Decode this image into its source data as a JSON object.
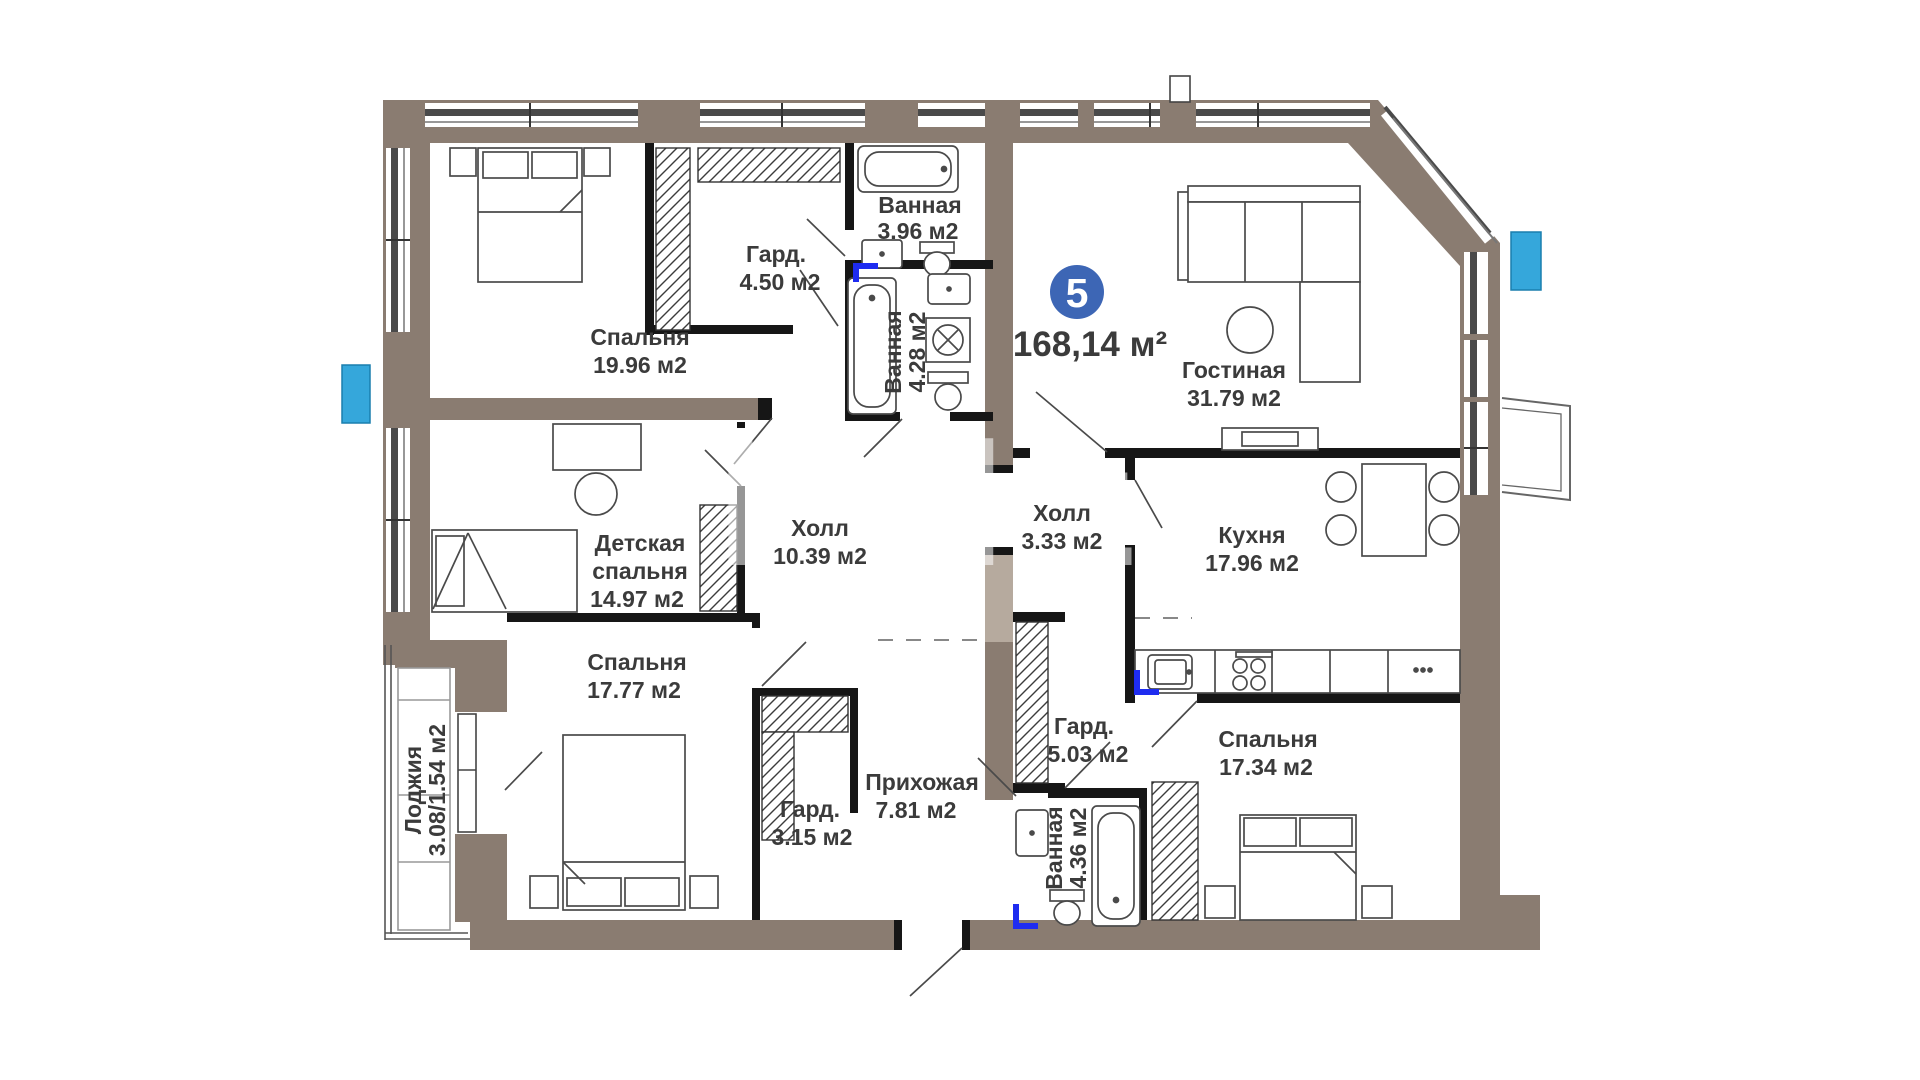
{
  "badge": {
    "number": "5",
    "total_area": "168,14 м²"
  },
  "watermark": {
    "text": "kn.kz"
  },
  "rooms": {
    "bedroom1": {
      "name": "Спальня",
      "area": "19.96 м2"
    },
    "wardrobe1": {
      "name": "Гард.",
      "area": "4.50 м2"
    },
    "bath1": {
      "name": "Ванная",
      "area": "3.96 м2"
    },
    "bath2": {
      "name": "Ванная",
      "area": "4.28 м2"
    },
    "living": {
      "name": "Гостиная",
      "area": "31.79 м2"
    },
    "kitchen": {
      "name": "Кухня",
      "area": "17.96 м2"
    },
    "hall_small": {
      "name": "Холл",
      "area": "3.33 м2"
    },
    "hall": {
      "name": "Холл",
      "area": "10.39 м2"
    },
    "kids": {
      "name_line1": "Детская",
      "name_line2": "спальня",
      "area": "14.97 м2"
    },
    "bedroom2": {
      "name": "Спальня",
      "area": "17.77 м2"
    },
    "loggia": {
      "name": "Лоджия",
      "area": "3.08/1.54 м2"
    },
    "wardrobe2": {
      "name": "Гард.",
      "area": "3.15 м2"
    },
    "entry": {
      "name": "Прихожая",
      "area": "7.81 м2"
    },
    "wardrobe3": {
      "name": "Гард.",
      "area": "5.03 м2"
    },
    "bath3": {
      "name": "Ванная",
      "area": "4.36 м2"
    },
    "bedroom3": {
      "name": "Спальня",
      "area": "17.34 м2"
    }
  },
  "colors": {
    "exterior_wall": "#8a7c71",
    "exterior_wall_light": "#b6aa9e",
    "interior_wall": "#161616",
    "window_glass": "#4a4a4a",
    "accent_cyan": "#35a7db",
    "plumbing_blue": "#1e2cf0",
    "badge_blue": "#3d66b5",
    "text": "#3b3b3b"
  }
}
